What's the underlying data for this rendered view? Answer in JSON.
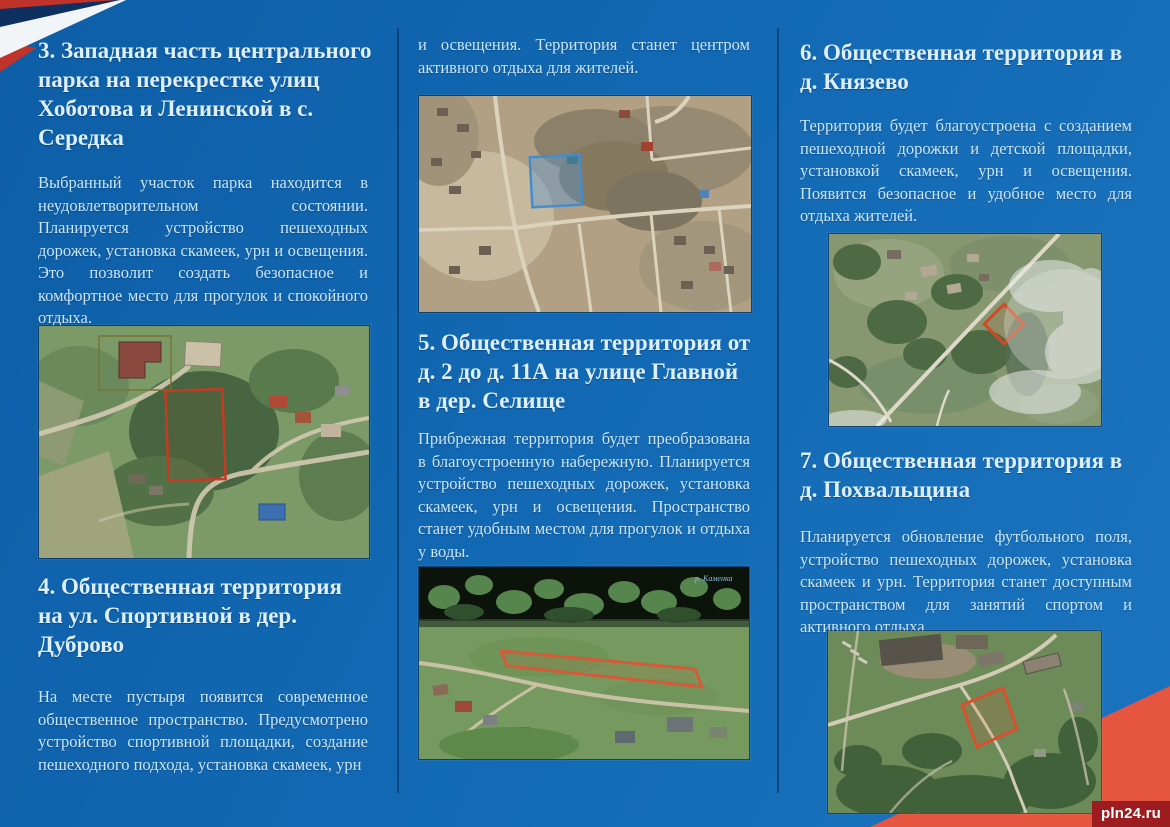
{
  "page": {
    "watermark": "pln24.ru",
    "background_color": "#1268b2",
    "heading_color": "#dceffb",
    "body_color": "#cbe6f6",
    "ribbon_colors": {
      "red": "#bf332a",
      "navy": "#0e3060",
      "white": "#f2f5f7"
    },
    "corner_wedge_color": "#e65540"
  },
  "sections": {
    "s3": {
      "title": "3. Западная часть центрального парка на перекрестке улиц Хоботова и Ленинской в с. Середка",
      "body": "Выбранный участок парка находится в неудовлетворительном состоянии. Планируется устройство пешеходных дорожек, установка скамеек, урн и освещения. Это позволит создать безопасное и комфортное место для прогулок и спокойного отдыха."
    },
    "s4": {
      "title": "4. Общественная территория на ул. Спортивной в дер. Дуброво",
      "body": "На месте пустыря появится современное общественное пространство. Предусмотрено устройство спортивной площадки, создание пешеходного подхода, установка скамеек, урн",
      "body_continued": "и освещения. Территория станет центром активного отдыха для жителей."
    },
    "s5": {
      "title": "5. Общественная территория от д. 2 до д. 11А на улице Главной в дер. Селище",
      "body": "Прибрежная территория будет преобразована в благоустроенную набережную. Планируется устройство пешеходных дорожек, установка скамеек, урн и освещения. Пространство станет удобным местом для прогулок и отдыха у воды."
    },
    "s6": {
      "title": "6. Общественная территория в д. Князево",
      "body": "Территория будет благоустроена с созданием пешеходной дорожки и детской площадки, установкой скамеек, урн и освещения. Появится безопасное и удобное место для отдыха жителей."
    },
    "s7": {
      "title": "7. Общественная территория в д. Похвальщина",
      "body": "Планируется обновление футбольного поля, устройство пешеходных дорожек, установка скамеек и урн. Территория станет доступным пространством для занятий спортом и активного отдыха"
    }
  },
  "images": {
    "seredka": {
      "plot_color": "#c53a23"
    },
    "dubrovo": {
      "plot_color": "#458ccd"
    },
    "selishche": {
      "plot_color": "#d65a38",
      "river_label": "р. Каменка"
    },
    "knyazevo": {
      "plot_color": "#cf4a28"
    },
    "pokhvalshchina": {
      "plot_color": "#d9502e"
    }
  }
}
